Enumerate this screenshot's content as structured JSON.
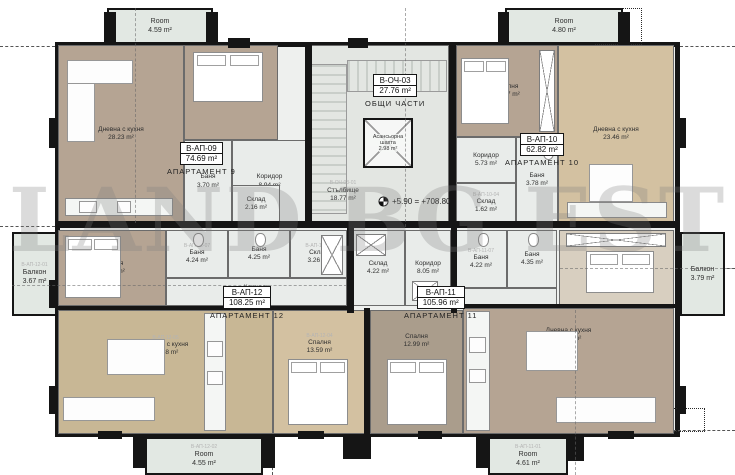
{
  "watermark": "LAND BG EST",
  "palette": {
    "wall": "#151515",
    "tile": "#e9ecea",
    "wood_dark": "#b5a493",
    "wood_light": "#d3c1a1",
    "balcony": "#e2e8e3"
  },
  "common": {
    "header_id": "В-ОЧ-03",
    "header_area": "27.76 m²",
    "header_caption": "ОБЩИ ЧАСТИ",
    "elevator": {
      "name": "Асансьорна шахта",
      "area": "2.98 m²"
    },
    "stairs": {
      "code": "В-ОЧ-03-01",
      "name": "Стълбище",
      "area": "18.77 m²"
    },
    "elevation": "+5.90 = +708.80"
  },
  "apartments": [
    {
      "id": "В-АП-09",
      "area": "74.69 m²",
      "caption": "АПАРТАМЕНТ 9"
    },
    {
      "id": "В-АП-10",
      "area": "62.82 m²",
      "caption": "АПАРТАМЕНТ 10"
    },
    {
      "id": "В-АП-11",
      "area": "105.96 m²",
      "caption": "АПАРТАМЕНТ 11"
    },
    {
      "id": "В-АП-12",
      "area": "108.25 m²",
      "caption": "АПАРТАМЕНТ 12"
    }
  ],
  "rooms": [
    {
      "name": "Дневна с кухня",
      "area": "28.23 m²"
    },
    {
      "name": "Спалня",
      "area": "14.95 m²"
    },
    {
      "name": "Коридор",
      "area": "8.94 m²"
    },
    {
      "name": "Баня",
      "area": "3.70 m²"
    },
    {
      "name": "Склад",
      "area": "2.16 m²"
    },
    {
      "name": "Спалня",
      "area": "12.67 m²"
    },
    {
      "name": "Дневна с кухня",
      "area": "23.46 m²"
    },
    {
      "name": "Коридор",
      "area": "5.73 m²"
    },
    {
      "name": "Баня",
      "area": "3.78 m²"
    },
    {
      "code": "В-АП-10-04",
      "name": "Склад",
      "area": "1.62 m²"
    },
    {
      "name": "Спалня",
      "area": "14.90 m²"
    },
    {
      "code": "В-АП-12-07",
      "name": "Баня",
      "area": "4.24 m²"
    },
    {
      "name": "Баня",
      "area": "4.25 m²"
    },
    {
      "code": "В-АП-12-03",
      "name": "Склад",
      "area": "3.26 m²"
    },
    {
      "name": "Коридор",
      "area": "10.20 m²"
    },
    {
      "name": "Склад",
      "area": "4.22 m²"
    },
    {
      "name": "Коридор",
      "area": "8.05 m²"
    },
    {
      "code": "В-АП-11-07",
      "name": "Баня",
      "area": "4.22 m²"
    },
    {
      "name": "Баня",
      "area": "4.35 m²"
    },
    {
      "name": "Спалня",
      "area": "14.78 m²"
    },
    {
      "code": "В-АП-12-05",
      "name": "Дневна с кухня",
      "area": "33.68 m²"
    },
    {
      "code": "В-АП-12-04",
      "name": "Спалня",
      "area": "13.59 m²"
    },
    {
      "name": "Спалня",
      "area": "12.99 m²"
    },
    {
      "name": "Дневна с кухня",
      "area": "33.70 m²"
    },
    {
      "name": "Room",
      "area": "4.59 m²"
    },
    {
      "name": "Room",
      "area": "4.80 m²"
    },
    {
      "code": "В-АП-12-02",
      "name": "Room",
      "area": "4.55 m²"
    },
    {
      "code": "В-АП-11-01",
      "name": "Room",
      "area": "4.61 m²"
    },
    {
      "code": "В-АП-12-01",
      "name": "Балкон",
      "area": "3.67 m²"
    },
    {
      "name": "Балкон",
      "area": "3.79 m²"
    }
  ]
}
